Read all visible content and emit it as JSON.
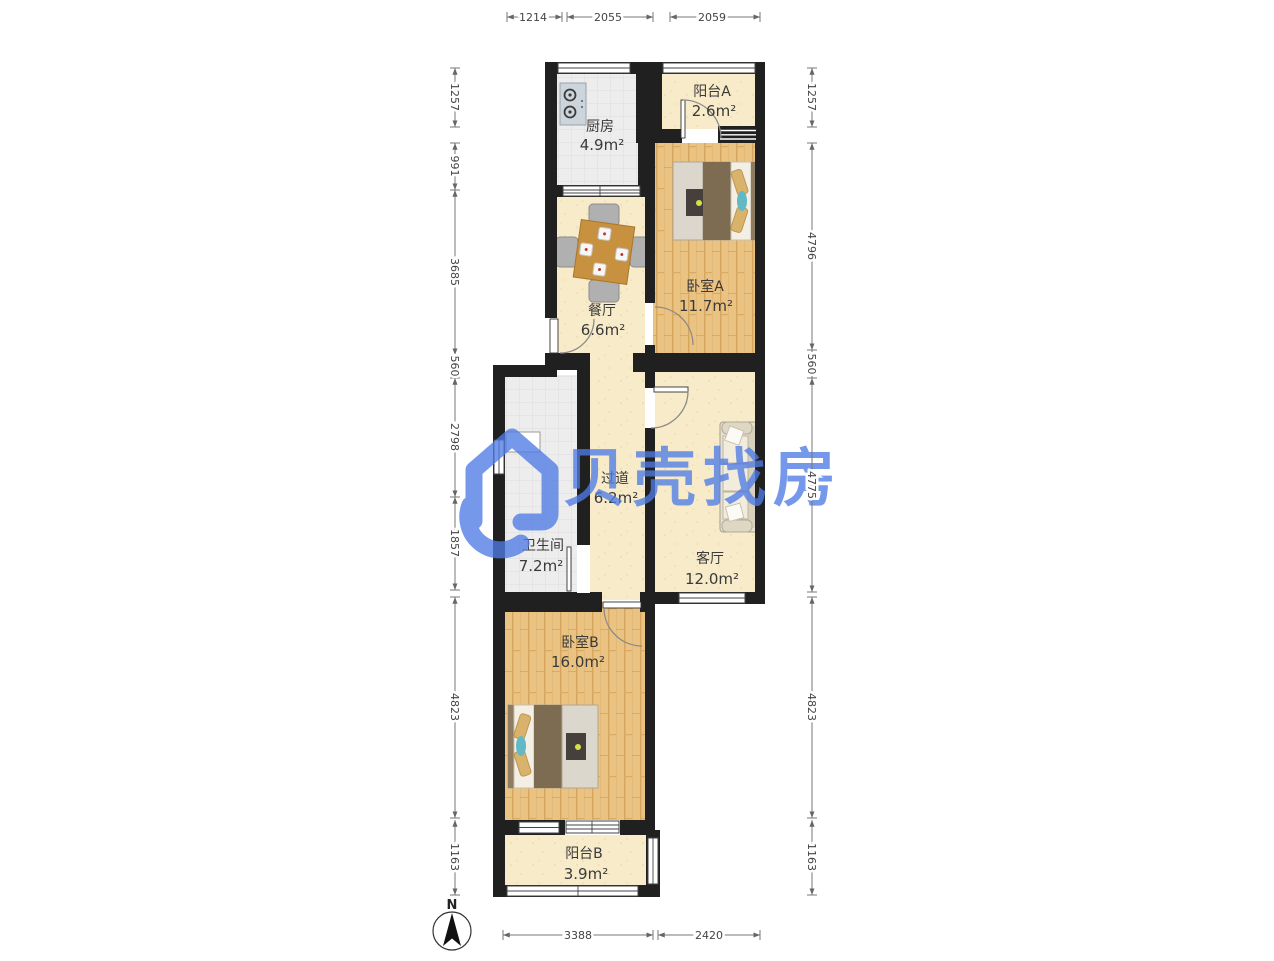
{
  "watermark": {
    "text": "贝壳找房",
    "color": "#4f7ce5"
  },
  "compass": {
    "label": "N"
  },
  "rooms": {
    "kitchen": {
      "name": "厨房",
      "area": "4.9m²"
    },
    "balcony_a": {
      "name": "阳台A",
      "area": "2.6m²"
    },
    "bedroom_a": {
      "name": "卧室A",
      "area": "11.7m²"
    },
    "dining": {
      "name": "餐厅",
      "area": "6.6m²"
    },
    "hallway": {
      "name": "过道",
      "area": "6.2m²"
    },
    "bathroom": {
      "name": "卫生间",
      "area": "7.2m²"
    },
    "living": {
      "name": "客厅",
      "area": "12.0m²"
    },
    "bedroom_b": {
      "name": "卧室B",
      "area": "16.0m²"
    },
    "balcony_b": {
      "name": "阳台B",
      "area": "3.9m²"
    }
  },
  "dimensions_mm": {
    "top": [
      "1214",
      "2055",
      "2059"
    ],
    "bottom": [
      "3388",
      "2420"
    ],
    "left": [
      "1257",
      "991",
      "3685",
      "560",
      "2798",
      "1857",
      "4823",
      "1163"
    ],
    "right": [
      "1257",
      "4796",
      "560",
      "4775",
      "4823",
      "1163"
    ]
  },
  "colors": {
    "wall": "#202020",
    "wood_floor": "#eac282",
    "cream_floor": "#f7ebc9",
    "tile_floor": "#ededed",
    "watermark_blue": "#4f7ce5"
  }
}
